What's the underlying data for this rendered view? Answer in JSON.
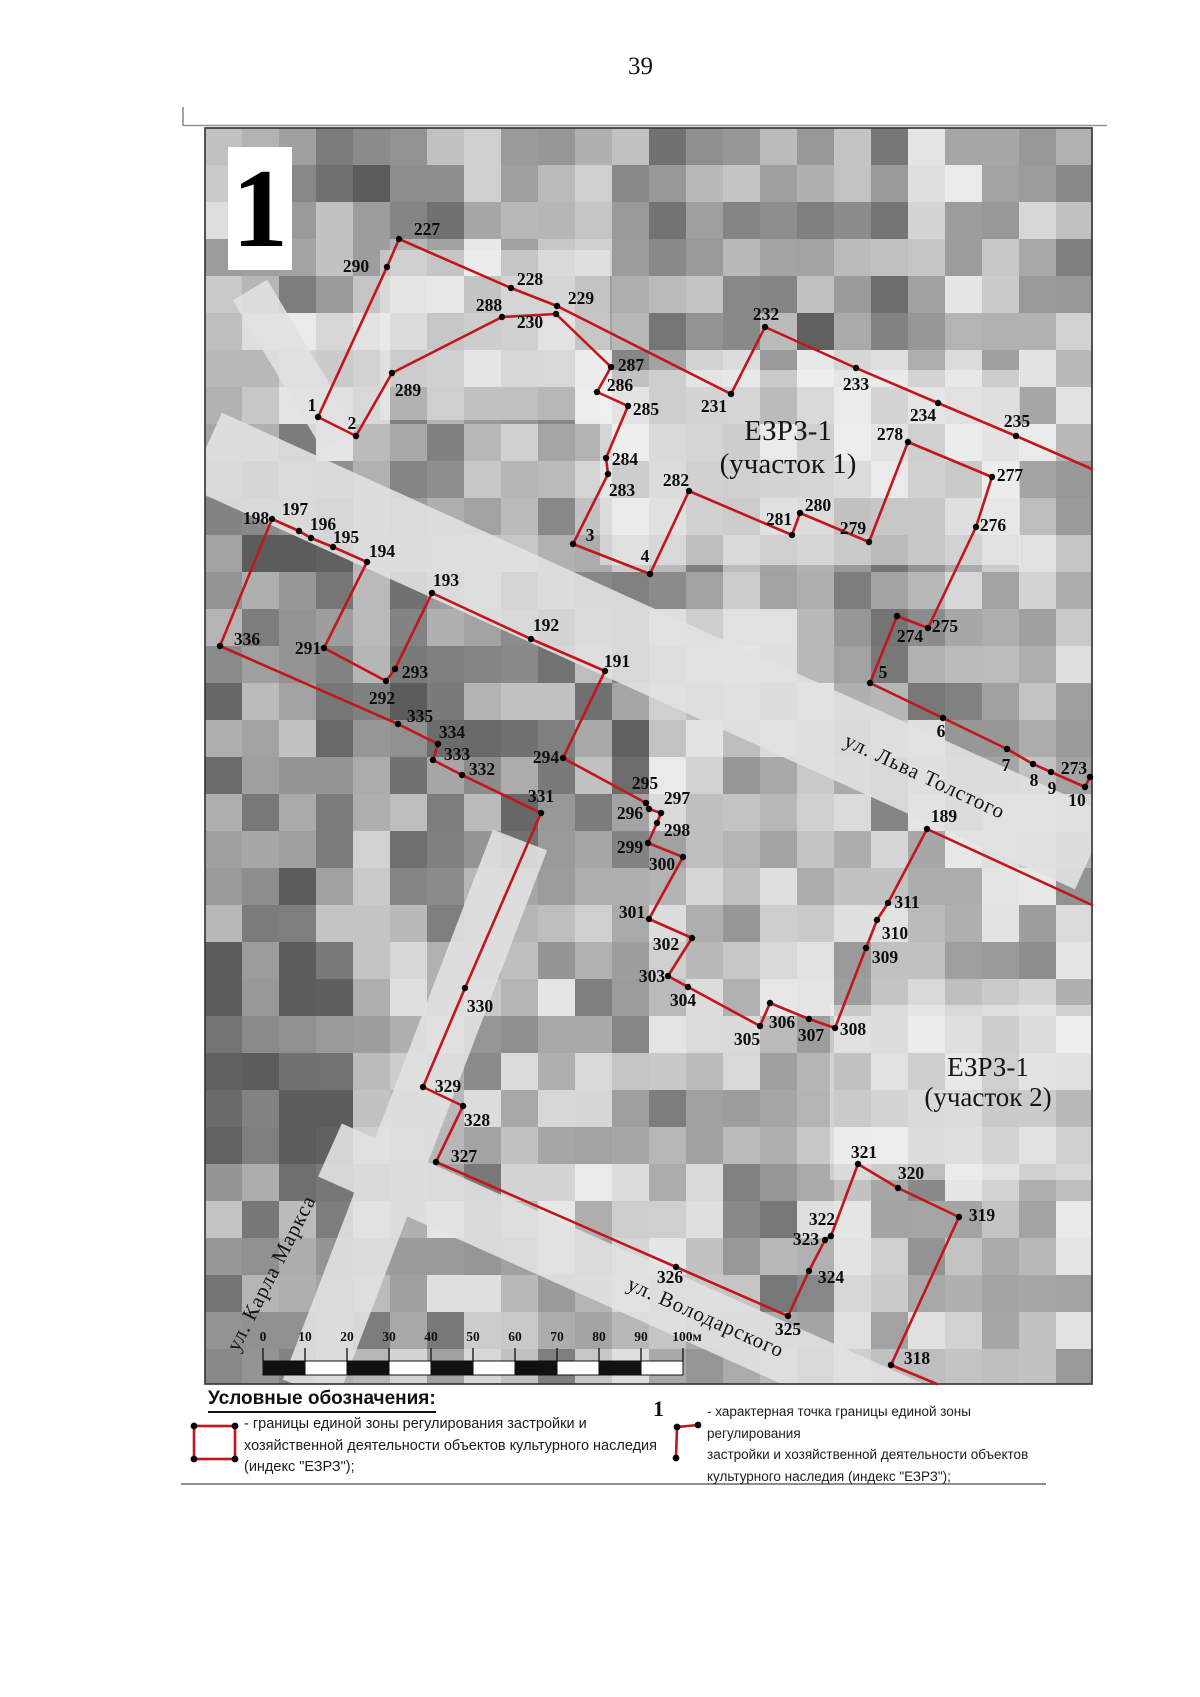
{
  "page": {
    "number": "39"
  },
  "map": {
    "plate_label": "1",
    "colors": {
      "boundary": "#c2161c",
      "dot": "#000000",
      "label": "#0d0d0d"
    },
    "zone_labels": [
      {
        "lines": [
          "ЕЗРЗ-1",
          "(участок 1)"
        ],
        "x": 788,
        "y": 431,
        "font": 29,
        "gap": 33
      },
      {
        "lines": [
          "ЕЗРЗ-1",
          "(участок 2)"
        ],
        "x": 988,
        "y": 1067,
        "font": 27,
        "gap": 30
      }
    ],
    "street_labels": [
      {
        "name": "ул. Льва Толстого",
        "x": 925,
        "y": 776,
        "angle": 25
      },
      {
        "name": "ул. Карла Маркса",
        "x": 271,
        "y": 1273,
        "angle": -63
      },
      {
        "name": "ул. Володарского",
        "x": 706,
        "y": 1317,
        "angle": 24
      }
    ],
    "scale_bar": {
      "x": 263,
      "interval_px": 42,
      "y_labels": 1344,
      "y_bar": 1361,
      "bar_height": 14,
      "labels": [
        "0",
        "10",
        "20",
        "30",
        "40",
        "50",
        "60",
        "70",
        "80",
        "90",
        "100м"
      ]
    },
    "point_fields": [
      "id",
      "x",
      "y",
      "label_x",
      "label_y"
    ],
    "points": [
      [
        "1",
        318,
        417,
        312,
        405
      ],
      [
        "2",
        356,
        436,
        352,
        423
      ],
      [
        "3",
        573,
        544,
        590,
        535
      ],
      [
        "4",
        650,
        574,
        645,
        556
      ],
      [
        "5",
        870,
        683,
        883,
        672
      ],
      [
        "6",
        943,
        718,
        941,
        731
      ],
      [
        "7",
        1007,
        749,
        1006,
        765
      ],
      [
        "8",
        1033,
        764,
        1034,
        780
      ],
      [
        "9",
        1051,
        772,
        1052,
        788
      ],
      [
        "10",
        1085,
        787,
        1077,
        800
      ],
      [
        "189",
        927,
        829,
        944,
        816
      ],
      [
        "191",
        605,
        671,
        617,
        661
      ],
      [
        "192",
        531,
        639,
        546,
        625
      ],
      [
        "193",
        432,
        593,
        446,
        580
      ],
      [
        "194",
        367,
        562,
        382,
        551
      ],
      [
        "195",
        333,
        547,
        346,
        537
      ],
      [
        "196",
        311,
        538,
        323,
        524
      ],
      [
        "197",
        299,
        531,
        295,
        509
      ],
      [
        "198",
        272,
        519,
        256,
        518
      ],
      [
        "227",
        399,
        239,
        427,
        229
      ],
      [
        "228",
        511,
        288,
        530,
        279
      ],
      [
        "229",
        557,
        306,
        581,
        298
      ],
      [
        "230",
        556,
        314,
        530,
        322
      ],
      [
        "231",
        731,
        394,
        714,
        406
      ],
      [
        "232",
        765,
        327,
        766,
        314
      ],
      [
        "233",
        856,
        368,
        856,
        384
      ],
      [
        "234",
        938,
        403,
        923,
        415
      ],
      [
        "235",
        1016,
        436,
        1017,
        421
      ],
      [
        "273",
        1090,
        777,
        1074,
        768
      ],
      [
        "274",
        897,
        616,
        910,
        636
      ],
      [
        "275",
        928,
        628,
        945,
        626
      ],
      [
        "276",
        976,
        527,
        993,
        525
      ],
      [
        "277",
        992,
        477,
        1010,
        475
      ],
      [
        "278",
        908,
        442,
        890,
        434
      ],
      [
        "279",
        869,
        542,
        853,
        528
      ],
      [
        "280",
        800,
        513,
        818,
        505
      ],
      [
        "281",
        792,
        535,
        779,
        519
      ],
      [
        "282",
        689,
        491,
        676,
        480
      ],
      [
        "283",
        608,
        474,
        622,
        490
      ],
      [
        "284",
        606,
        458,
        625,
        459
      ],
      [
        "285",
        628,
        406,
        646,
        409
      ],
      [
        "286",
        597,
        392,
        620,
        385
      ],
      [
        "287",
        611,
        367,
        631,
        365
      ],
      [
        "288",
        502,
        317,
        489,
        305
      ],
      [
        "289",
        392,
        373,
        408,
        390
      ],
      [
        "290",
        387,
        267,
        356,
        266
      ],
      [
        "291",
        324,
        648,
        308,
        648
      ],
      [
        "292",
        386,
        681,
        382,
        698
      ],
      [
        "293",
        395,
        669,
        415,
        672
      ],
      [
        "294",
        563,
        758,
        546,
        757
      ],
      [
        "295",
        646,
        803,
        645,
        783
      ],
      [
        "296",
        649,
        809,
        630,
        813
      ],
      [
        "297",
        661,
        813,
        677,
        798
      ],
      [
        "298",
        657,
        823,
        677,
        830
      ],
      [
        "299",
        648,
        843,
        630,
        847
      ],
      [
        "300",
        683,
        857,
        662,
        864
      ],
      [
        "301",
        649,
        919,
        632,
        912
      ],
      [
        "302",
        692,
        938,
        666,
        944
      ],
      [
        "303",
        668,
        976,
        652,
        976
      ],
      [
        "304",
        688,
        987,
        683,
        1000
      ],
      [
        "305",
        760,
        1026,
        747,
        1039
      ],
      [
        "306",
        770,
        1003,
        782,
        1022
      ],
      [
        "307",
        809,
        1019,
        811,
        1035
      ],
      [
        "308",
        835,
        1028,
        853,
        1029
      ],
      [
        "309",
        866,
        948,
        885,
        957
      ],
      [
        "310",
        877,
        920,
        895,
        933
      ],
      [
        "311",
        888,
        903,
        907,
        902
      ],
      [
        "318",
        891,
        1365,
        917,
        1358
      ],
      [
        "319",
        959,
        1217,
        982,
        1215
      ],
      [
        "320",
        898,
        1188,
        911,
        1173
      ],
      [
        "321",
        858,
        1164,
        864,
        1152
      ],
      [
        "322",
        831,
        1236,
        822,
        1219
      ],
      [
        "323",
        825,
        1240,
        806,
        1239
      ],
      [
        "324",
        809,
        1271,
        831,
        1277
      ],
      [
        "325",
        788,
        1316,
        788,
        1329
      ],
      [
        "326",
        676,
        1267,
        670,
        1277
      ],
      [
        "327",
        436,
        1162,
        464,
        1156
      ],
      [
        "328",
        463,
        1106,
        477,
        1120
      ],
      [
        "329",
        423,
        1087,
        448,
        1086
      ],
      [
        "330",
        465,
        988,
        480,
        1006
      ],
      [
        "331",
        541,
        813,
        541,
        796
      ],
      [
        "332",
        462,
        775,
        482,
        769
      ],
      [
        "333",
        433,
        760,
        457,
        754
      ],
      [
        "334",
        438,
        744,
        452,
        732
      ],
      [
        "335",
        398,
        724,
        420,
        716
      ],
      [
        "336",
        220,
        646,
        247,
        639
      ]
    ],
    "zones": [
      {
        "name": "ЕЗРЗ-1 (участок 1)",
        "paths": [
          [
            "1",
            "290",
            "227",
            "228",
            "229",
            "231",
            "232",
            "233",
            "234",
            "235",
            "@1092,469"
          ],
          [
            "1",
            "2"
          ],
          [
            "2",
            "289",
            "288",
            "230",
            "287",
            "286",
            "285",
            "284",
            "283",
            "3",
            "4",
            "282",
            "281",
            "280",
            "279",
            "278",
            "277",
            "276",
            "275",
            "274",
            "5",
            "6",
            "7",
            "8",
            "9",
            "10",
            "273"
          ]
        ]
      },
      {
        "name": "ЕЗРЗ-1 (участок 2)",
        "paths": [
          [
            "189",
            "311",
            "310",
            "309",
            "308",
            "307",
            "306",
            "305",
            "304",
            "303",
            "302",
            "301",
            "300",
            "299",
            "298",
            "297",
            "296",
            "295",
            "294",
            "191",
            "192",
            "193",
            "293",
            "292",
            "291",
            "194",
            "195",
            "196",
            "197",
            "198",
            "336",
            "335",
            "334",
            "333",
            "332",
            "331",
            "330",
            "329",
            "328",
            "327",
            "326",
            "325",
            "324",
            "323",
            "322",
            "321",
            "320",
            "319",
            "318",
            "@937,1384"
          ],
          [
            "189",
            "@1092,905"
          ]
        ]
      }
    ]
  },
  "legend": {
    "heading": "Условные обозначения:",
    "items": [
      {
        "symbol": "zone-boundary-rect",
        "label_lines": [
          "- границы единой зоны регулирования застройки и",
          "хозяйственной деятельности объектов культурного наследия",
          "(индекс \"ЕЗРЗ\");"
        ]
      },
      {
        "symbol": "boundary-point-marker",
        "marker_number": "1",
        "label_lines": [
          "- характерная точка границы единой зоны регулирования",
          "застройки и хозяйственной деятельности объектов",
          "культурного наследия (индекс \"ЕЗРЗ\");"
        ]
      }
    ]
  }
}
